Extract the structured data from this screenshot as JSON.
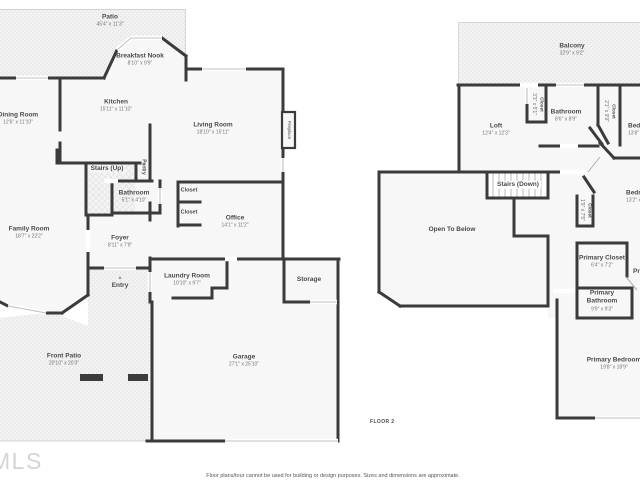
{
  "page": {
    "floor_tag": "FLOOR 2",
    "disclaimer": "Floor plans/tour cannot be used for building or design purposes. Sizes and dimensions are approximate.",
    "watermark": "MLS",
    "entry_arrow": "▲"
  },
  "colors": {
    "wall": "#3b3b3b",
    "room_fill": "#f7f7f7",
    "outdoor_fill": "#f1f1f1",
    "label": "#4a4a4a",
    "dims": "#757575"
  },
  "floor1": {
    "rooms": [
      {
        "name": "Patio",
        "dims": "45'4\" x 11'3\""
      },
      {
        "name": "Breakfast Nook",
        "dims": "8'10\" x 9'9\""
      },
      {
        "name": "Kitchen",
        "dims": "15'11\" x 11'10\""
      },
      {
        "name": "Dining Room",
        "dims": "12'6\" x 11'10\""
      },
      {
        "name": "Living Room",
        "dims": "18'10\" x 15'11\""
      },
      {
        "name": "Fireplace"
      },
      {
        "name": "Stairs (Up)"
      },
      {
        "name": "Pantry"
      },
      {
        "name": "Bathroom",
        "dims": "5'1\" x 4'10\""
      },
      {
        "name": "Closet"
      },
      {
        "name": "Closet"
      },
      {
        "name": "Office",
        "dims": "14'1\" x 11'2\""
      },
      {
        "name": "Family Room",
        "dims": "18'7\" x 22'2\""
      },
      {
        "name": "Foyer",
        "dims": "8'11\" x 7'9\""
      },
      {
        "name": "Entry"
      },
      {
        "name": "Laundry Room",
        "dims": "10'10\" x 9'7\""
      },
      {
        "name": "Storage"
      },
      {
        "name": "Garage",
        "dims": "27'1\" x 25'10\""
      },
      {
        "name": "Front Patio",
        "dims": "20'10\" x 20'3\""
      }
    ]
  },
  "floor2": {
    "rooms": [
      {
        "name": "Balcony",
        "dims": "32'9\" x 9'2\""
      },
      {
        "name": "Loft",
        "dims": "12'4\" x 12'3\""
      },
      {
        "name": "Closet",
        "dims": "3'3\" x 5'1\""
      },
      {
        "name": "Bathroom",
        "dims": "8'6\" x 8'9\""
      },
      {
        "name": "Closet",
        "dims": "2'1\" x 9'9\""
      },
      {
        "name": "Bedroom",
        "dims": "13'8\" x 11'6\""
      },
      {
        "name": "Stairs (Down)"
      },
      {
        "name": "Open To Below"
      },
      {
        "name": "Closet",
        "dims": "1'9\" x 7'5\""
      },
      {
        "name": "Primary Closet",
        "dims": "6'4\" x 7'2\""
      },
      {
        "name": "Primary"
      },
      {
        "name": "Primary Bathroom",
        "dims": "9'9\" x 9'3\""
      },
      {
        "name": "Bedroom",
        "dims": "13'2\" x 11'4\""
      },
      {
        "name": "Primary Bedroom",
        "dims": "19'8\" x 18'9\""
      }
    ]
  }
}
